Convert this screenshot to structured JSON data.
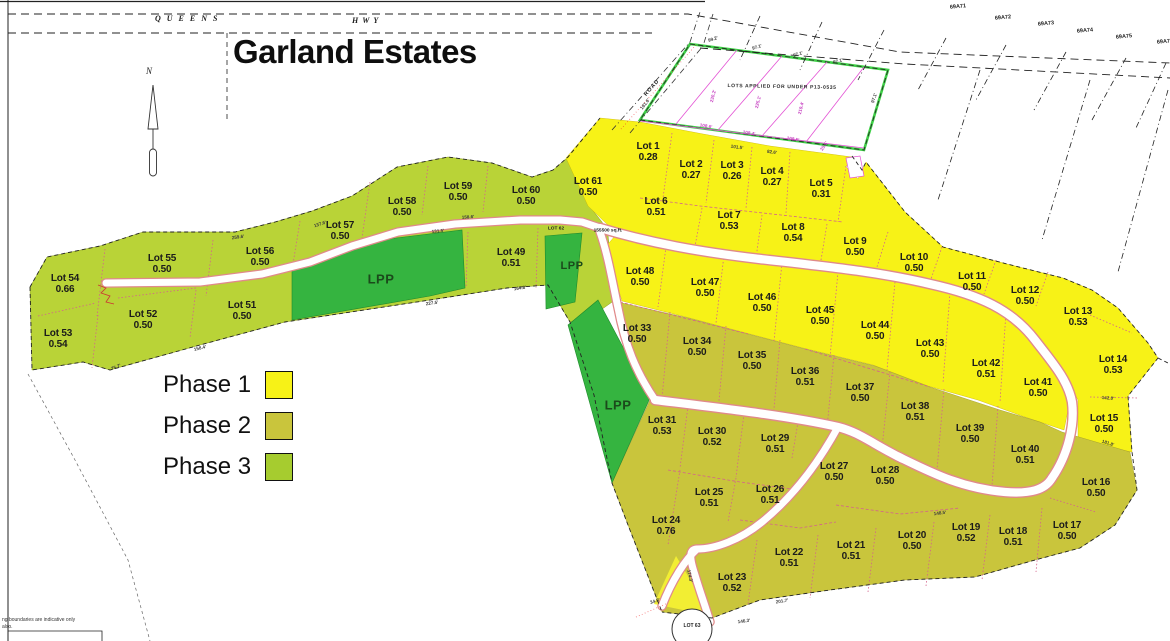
{
  "title": "Garland Estates",
  "highway": {
    "left": "QUEENS",
    "right": "HWY"
  },
  "north_label": "N",
  "pending": {
    "label": "LOTS APPLIED FOR UNDER P13-0535",
    "road": "ROAD"
  },
  "road_lot62": {
    "name": "LOT 62",
    "area": "155500 sq.ft."
  },
  "lot63_label": "LOT 63",
  "note": {
    "line1": "ng boundaries are indicative only",
    "line2": "also."
  },
  "legend": {
    "items": [
      {
        "label": "Phase 1",
        "color": "#f7f217"
      },
      {
        "label": "Phase 2",
        "color": "#c9c53c"
      },
      {
        "label": "Phase 3",
        "color": "#a6cc2f"
      }
    ]
  },
  "colors": {
    "phase1": "#f7f217",
    "phase2": "#c9c53c",
    "phase3": "#b9d337",
    "lpp_green": "#35b440",
    "pending_border": "#3ecf46",
    "road_edge": "#e08a8a",
    "survey_magenta": "#e352d4"
  },
  "parcels_top_right": [
    {
      "t": "69A71",
      "x": 958,
      "y": 7
    },
    {
      "t": "69A72",
      "x": 1003,
      "y": 18
    },
    {
      "t": "69A73",
      "x": 1046,
      "y": 24
    },
    {
      "t": "69A74",
      "x": 1085,
      "y": 31
    },
    {
      "t": "69A75",
      "x": 1124,
      "y": 37
    },
    {
      "t": "69A76",
      "x": 1165,
      "y": 42
    }
  ],
  "lpp_labels": [
    {
      "t": "LPP",
      "x": 381,
      "y": 279,
      "s": 13
    },
    {
      "t": "LPP",
      "x": 572,
      "y": 266,
      "s": 11
    },
    {
      "t": "LPP",
      "x": 618,
      "y": 405,
      "s": 13
    }
  ],
  "lots": [
    {
      "name": "Lot 1",
      "area": "0.28",
      "x": 648,
      "y": 152,
      "phase": 1
    },
    {
      "name": "Lot 2",
      "area": "0.27",
      "x": 691,
      "y": 170,
      "phase": 1
    },
    {
      "name": "Lot 3",
      "area": "0.26",
      "x": 732,
      "y": 171,
      "phase": 1
    },
    {
      "name": "Lot 4",
      "area": "0.27",
      "x": 772,
      "y": 177,
      "phase": 1
    },
    {
      "name": "Lot 5",
      "area": "0.31",
      "x": 821,
      "y": 189,
      "phase": 1
    },
    {
      "name": "Lot 6",
      "area": "0.51",
      "x": 656,
      "y": 207,
      "phase": 1
    },
    {
      "name": "Lot 7",
      "area": "0.53",
      "x": 729,
      "y": 221,
      "phase": 1
    },
    {
      "name": "Lot 8",
      "area": "0.54",
      "x": 793,
      "y": 233,
      "phase": 1
    },
    {
      "name": "Lot 9",
      "area": "0.50",
      "x": 855,
      "y": 247,
      "phase": 1
    },
    {
      "name": "Lot 10",
      "area": "0.50",
      "x": 914,
      "y": 263,
      "phase": 1
    },
    {
      "name": "Lot 11",
      "area": "0.50",
      "x": 972,
      "y": 282,
      "phase": 1
    },
    {
      "name": "Lot 12",
      "area": "0.50",
      "x": 1025,
      "y": 296,
      "phase": 1
    },
    {
      "name": "Lot 13",
      "area": "0.53",
      "x": 1078,
      "y": 317,
      "phase": 1
    },
    {
      "name": "Lot 14",
      "area": "0.53",
      "x": 1113,
      "y": 365,
      "phase": 1
    },
    {
      "name": "Lot 15",
      "area": "0.50",
      "x": 1104,
      "y": 424,
      "phase": 1
    },
    {
      "name": "Lot 16",
      "area": "0.50",
      "x": 1096,
      "y": 488,
      "phase": 2
    },
    {
      "name": "Lot 17",
      "area": "0.50",
      "x": 1067,
      "y": 531,
      "phase": 2
    },
    {
      "name": "Lot 18",
      "area": "0.51",
      "x": 1013,
      "y": 537,
      "phase": 2
    },
    {
      "name": "Lot 19",
      "area": "0.52",
      "x": 966,
      "y": 533,
      "phase": 2
    },
    {
      "name": "Lot 20",
      "area": "0.50",
      "x": 912,
      "y": 541,
      "phase": 2
    },
    {
      "name": "Lot 21",
      "area": "0.51",
      "x": 851,
      "y": 551,
      "phase": 2
    },
    {
      "name": "Lot 22",
      "area": "0.51",
      "x": 789,
      "y": 558,
      "phase": 2
    },
    {
      "name": "Lot 23",
      "area": "0.52",
      "x": 732,
      "y": 583,
      "phase": 2
    },
    {
      "name": "Lot 24",
      "area": "0.76",
      "x": 666,
      "y": 526,
      "phase": 2
    },
    {
      "name": "Lot 25",
      "area": "0.51",
      "x": 709,
      "y": 498,
      "phase": 2
    },
    {
      "name": "Lot 26",
      "area": "0.51",
      "x": 770,
      "y": 495,
      "phase": 2
    },
    {
      "name": "Lot 27",
      "area": "0.50",
      "x": 834,
      "y": 472,
      "phase": 2
    },
    {
      "name": "Lot 28",
      "area": "0.50",
      "x": 885,
      "y": 476,
      "phase": 2
    },
    {
      "name": "Lot 29",
      "area": "0.51",
      "x": 775,
      "y": 444,
      "phase": 2
    },
    {
      "name": "Lot 30",
      "area": "0.52",
      "x": 712,
      "y": 437,
      "phase": 2
    },
    {
      "name": "Lot 31",
      "area": "0.53",
      "x": 662,
      "y": 426,
      "phase": 2
    },
    {
      "name": "Lot 33",
      "area": "0.50",
      "x": 637,
      "y": 334,
      "phase": 2
    },
    {
      "name": "Lot 34",
      "area": "0.50",
      "x": 697,
      "y": 347,
      "phase": 2
    },
    {
      "name": "Lot 35",
      "area": "0.50",
      "x": 752,
      "y": 361,
      "phase": 2
    },
    {
      "name": "Lot 36",
      "area": "0.51",
      "x": 805,
      "y": 377,
      "phase": 2
    },
    {
      "name": "Lot 37",
      "area": "0.50",
      "x": 860,
      "y": 393,
      "phase": 2
    },
    {
      "name": "Lot 38",
      "area": "0.51",
      "x": 915,
      "y": 412,
      "phase": 2
    },
    {
      "name": "Lot 39",
      "area": "0.50",
      "x": 970,
      "y": 434,
      "phase": 2
    },
    {
      "name": "Lot 40",
      "area": "0.51",
      "x": 1025,
      "y": 455,
      "phase": 2
    },
    {
      "name": "Lot 41",
      "area": "0.50",
      "x": 1038,
      "y": 388,
      "phase": 1
    },
    {
      "name": "Lot 42",
      "area": "0.51",
      "x": 986,
      "y": 369,
      "phase": 1
    },
    {
      "name": "Lot 43",
      "area": "0.50",
      "x": 930,
      "y": 349,
      "phase": 1
    },
    {
      "name": "Lot 44",
      "area": "0.50",
      "x": 875,
      "y": 331,
      "phase": 1
    },
    {
      "name": "Lot 45",
      "area": "0.50",
      "x": 820,
      "y": 316,
      "phase": 1
    },
    {
      "name": "Lot 46",
      "area": "0.50",
      "x": 762,
      "y": 303,
      "phase": 1
    },
    {
      "name": "Lot 47",
      "area": "0.50",
      "x": 705,
      "y": 288,
      "phase": 1
    },
    {
      "name": "Lot 48",
      "area": "0.50",
      "x": 640,
      "y": 277,
      "phase": 1
    },
    {
      "name": "Lot 49",
      "area": "0.51",
      "x": 511,
      "y": 258,
      "phase": 3
    },
    {
      "name": "Lot 51",
      "area": "0.50",
      "x": 242,
      "y": 311,
      "phase": 3
    },
    {
      "name": "Lot 52",
      "area": "0.50",
      "x": 143,
      "y": 320,
      "phase": 3
    },
    {
      "name": "Lot 53",
      "area": "0.54",
      "x": 58,
      "y": 339,
      "phase": 3
    },
    {
      "name": "Lot 54",
      "area": "0.66",
      "x": 65,
      "y": 284,
      "phase": 3
    },
    {
      "name": "Lot 55",
      "area": "0.50",
      "x": 162,
      "y": 264,
      "phase": 3
    },
    {
      "name": "Lot 56",
      "area": "0.50",
      "x": 260,
      "y": 257,
      "phase": 3
    },
    {
      "name": "Lot 57",
      "area": "0.50",
      "x": 340,
      "y": 231,
      "phase": 3
    },
    {
      "name": "Lot 58",
      "area": "0.50",
      "x": 402,
      "y": 207,
      "phase": 3
    },
    {
      "name": "Lot 59",
      "area": "0.50",
      "x": 458,
      "y": 192,
      "phase": 3
    },
    {
      "name": "Lot 60",
      "area": "0.50",
      "x": 526,
      "y": 196,
      "phase": 3
    },
    {
      "name": "Lot 61",
      "area": "0.50",
      "x": 588,
      "y": 187,
      "phase": 1
    }
  ],
  "dimensions": [
    {
      "t": "99.2'",
      "x": 713,
      "y": 39,
      "r": -18
    },
    {
      "t": "97.1'",
      "x": 757,
      "y": 47,
      "r": -17
    },
    {
      "t": "97.1'",
      "x": 798,
      "y": 54,
      "r": -16
    },
    {
      "t": "97.1'",
      "x": 838,
      "y": 61,
      "r": -15
    },
    {
      "t": "97.1'",
      "x": 874,
      "y": 98,
      "r": -72
    },
    {
      "t": "108.6'",
      "x": 706,
      "y": 126,
      "r": 10,
      "c": "m"
    },
    {
      "t": "108.4'",
      "x": 749,
      "y": 133,
      "r": 10,
      "c": "m"
    },
    {
      "t": "108.5'",
      "x": 793,
      "y": 139,
      "r": 10,
      "c": "m"
    },
    {
      "t": "101.5'",
      "x": 737,
      "y": 147,
      "r": 8
    },
    {
      "t": "82.6'",
      "x": 772,
      "y": 152,
      "r": 8
    },
    {
      "t": "25.5'",
      "x": 824,
      "y": 146,
      "r": -55,
      "c": "m"
    },
    {
      "t": "230.2'",
      "x": 713,
      "y": 96,
      "r": -76,
      "c": "m"
    },
    {
      "t": "225.1'",
      "x": 758,
      "y": 102,
      "r": -76,
      "c": "m"
    },
    {
      "t": "219.4'",
      "x": 801,
      "y": 108,
      "r": -76,
      "c": "m"
    },
    {
      "t": "191.6'",
      "x": 645,
      "y": 104,
      "r": -52
    },
    {
      "t": "164.8'",
      "x": 520,
      "y": 288,
      "r": -8
    },
    {
      "t": "227.5'",
      "x": 432,
      "y": 303,
      "r": -8
    },
    {
      "t": "158.4'",
      "x": 200,
      "y": 348,
      "r": -14
    },
    {
      "t": "75.7'",
      "x": 116,
      "y": 367,
      "r": -22
    },
    {
      "t": "259.6'",
      "x": 238,
      "y": 237,
      "r": -8
    },
    {
      "t": "137.6'",
      "x": 320,
      "y": 224,
      "r": -18
    },
    {
      "t": "131.5'",
      "x": 438,
      "y": 231,
      "r": -6
    },
    {
      "t": "158.6'",
      "x": 468,
      "y": 217,
      "r": -4
    },
    {
      "t": "142.0'",
      "x": 1108,
      "y": 398,
      "r": 4
    },
    {
      "t": "181.8'",
      "x": 1108,
      "y": 443,
      "r": 18
    },
    {
      "t": "201.7'",
      "x": 782,
      "y": 601,
      "r": -9
    },
    {
      "t": "174.3'",
      "x": 690,
      "y": 576,
      "r": 78
    },
    {
      "t": "34.9'",
      "x": 655,
      "y": 601,
      "r": -18
    },
    {
      "t": "148.5'",
      "x": 940,
      "y": 513,
      "r": -7
    },
    {
      "t": "146.3'",
      "x": 744,
      "y": 621,
      "r": -7
    }
  ]
}
